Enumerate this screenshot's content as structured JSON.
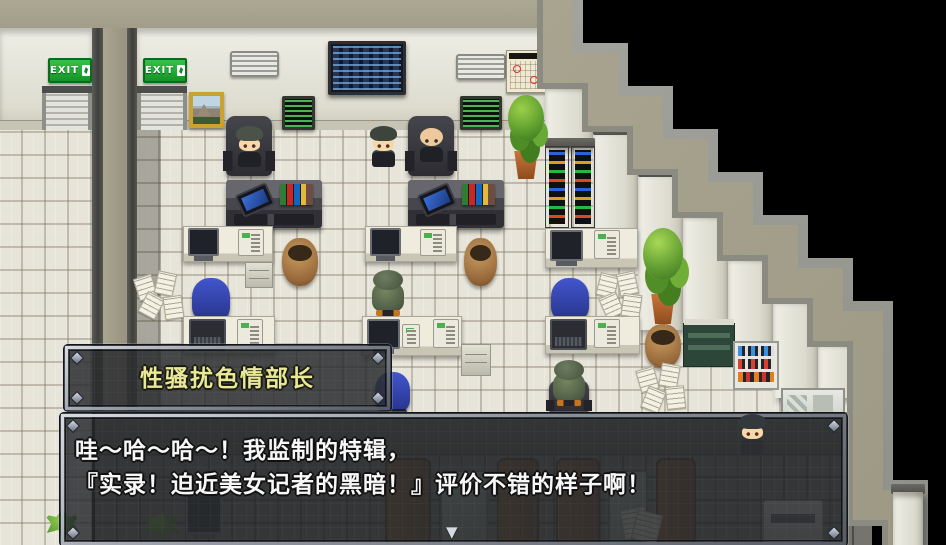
{
  "scene": {
    "exit_sign_label": "EXIT",
    "colors": {
      "exit_green": "#1f9d3a",
      "roof_khaki": "#a7a390",
      "wall_face": "#e4e2d8",
      "floor_light": "#e7e4d9",
      "floor_dark": "#75746d",
      "void_black": "#000000",
      "window_fill": "rgba(41,43,46,0.85)"
    }
  },
  "name_box": {
    "text": "性骚扰色情部长",
    "text_color": "#e9e897"
  },
  "dialogue_box": {
    "lines": [
      "哇～哈～哈～！我监制的特辑，",
      "『实录！迫近美女记者的黑暗！』评价不错的样子啊！"
    ],
    "text_color": "#f7f7f7",
    "continue_indicator": "▼"
  }
}
